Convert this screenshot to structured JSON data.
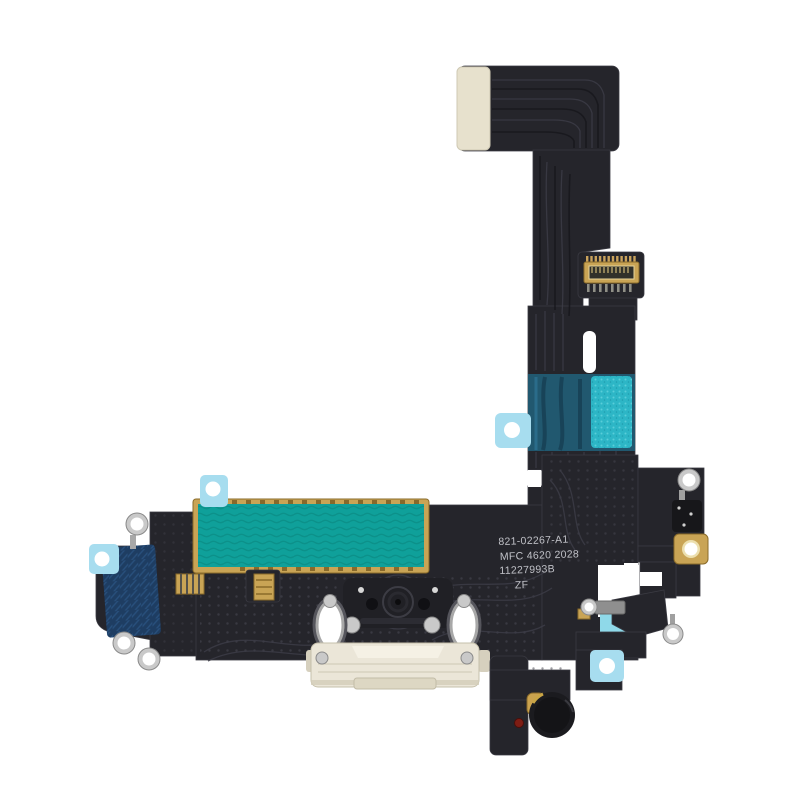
{
  "product_markings": {
    "line1": "821-02267-A1",
    "line2": "MFC 4620 2028",
    "line3": "11227993B",
    "line4": "ZF"
  },
  "colors": {
    "background": "#ffffff",
    "flex-black": "#25252b",
    "flex-edge": "#3a3a42",
    "teal-patch": "#0fa09a",
    "teal-dark": "#0b8d86",
    "bright-teal": "#2db6c6",
    "navy-patch": "#1e3d62",
    "blue-patch": "#21586f",
    "light-blue-tab": "#a7ddef",
    "cream-stiffener": "#e7e1cd",
    "port-cream": "#ebe6d8",
    "gold": "#c9a455",
    "gold-dark": "#8a6b2a",
    "silver": "#c9c9c9",
    "silver-dark": "#8a8a8a",
    "red-dot": "#7e1d14",
    "marking-text": "#c0c1c7"
  }
}
